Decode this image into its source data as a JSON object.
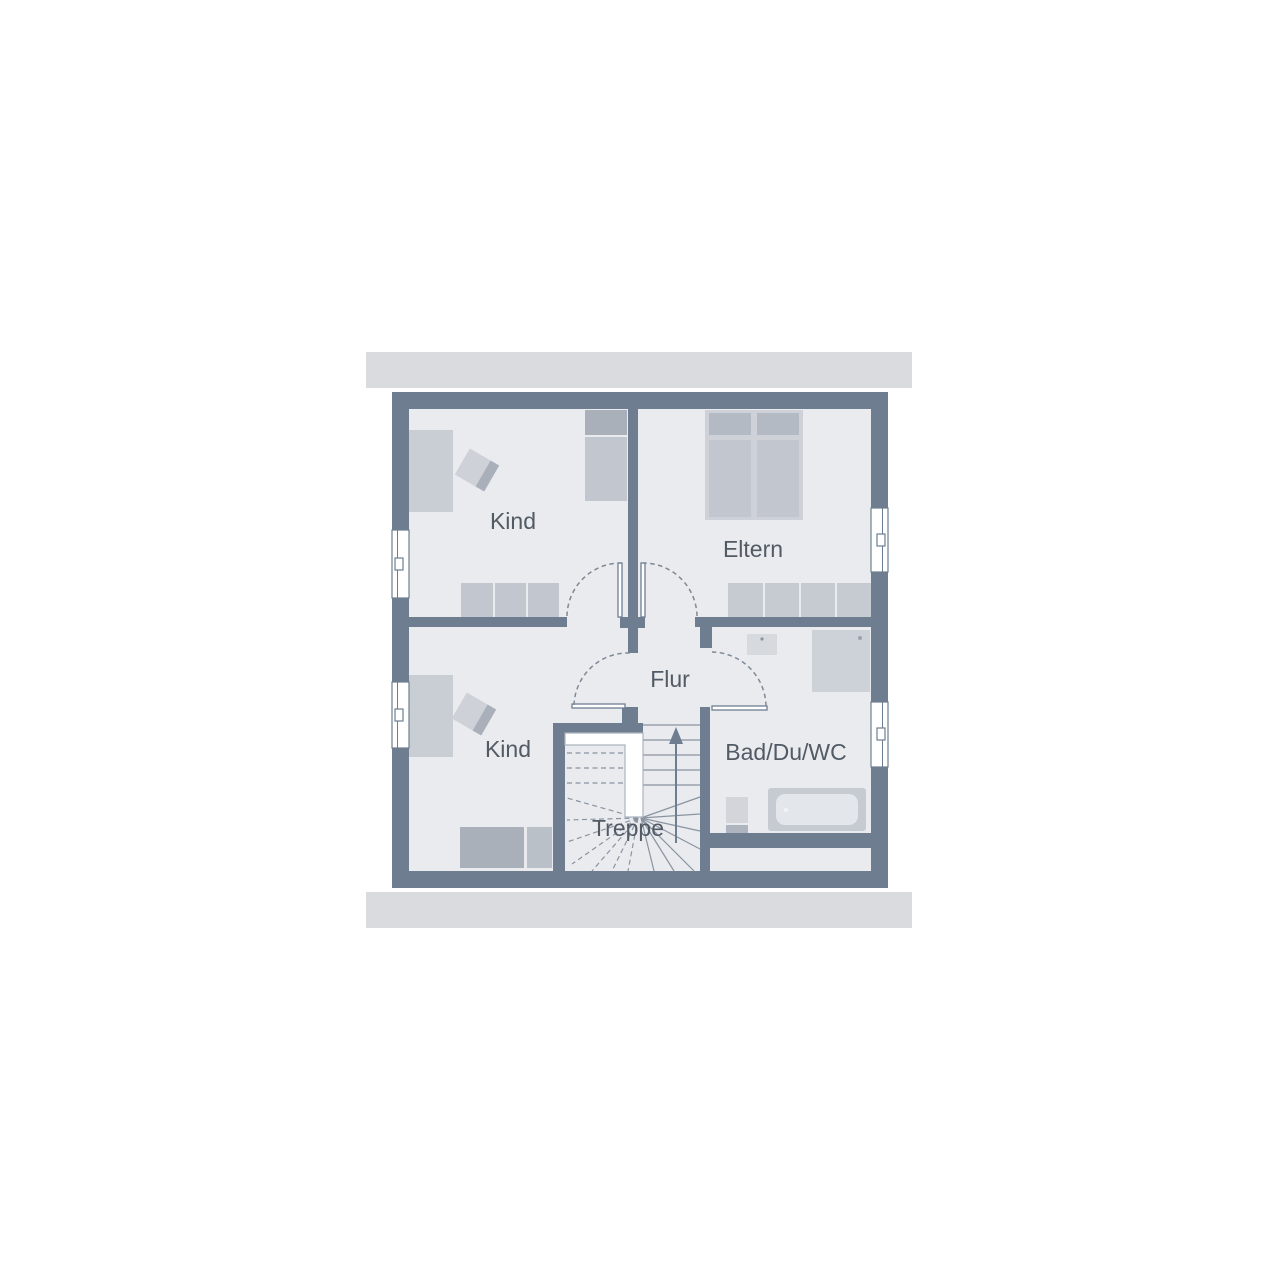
{
  "floor_plan": {
    "room_labels": {
      "kind_top": "Kind",
      "eltern": "Eltern",
      "kind_bottom": "Kind",
      "flur": "Flur",
      "bad": "Bad/Du/WC",
      "treppe": "Treppe"
    },
    "colors": {
      "wall": "#6e7e90",
      "floor": "#e9ebef",
      "roof_band": "#d9dbdf",
      "furniture_light": "#ced2d8",
      "furniture_mid": "#c2c7cf",
      "furniture_dark": "#a9b0ba",
      "bed": "#c9cdd4",
      "label_text": "#525a64",
      "stair_line": "#8a94a1",
      "window_fill": "#ffffff"
    }
  }
}
